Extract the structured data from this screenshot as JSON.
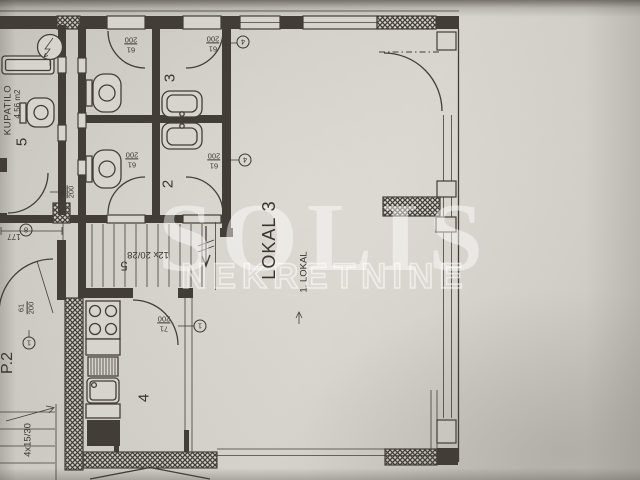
{
  "watermark": {
    "title": "SOLIS",
    "subtitle": "NEKRETNINE"
  },
  "rooms": {
    "kupatilo": {
      "name": "KUPATILO",
      "area": "4.56 m2",
      "number": "5"
    },
    "wc3": {
      "number": "3"
    },
    "wc2": {
      "number": "2"
    },
    "kitchen": {
      "number": "4"
    },
    "lokal": {
      "title": "LOKAL 3",
      "subtitle": "1. LOKAL"
    },
    "p2": {
      "label": "P.2"
    }
  },
  "stairs": {
    "main": {
      "label": "12x 20/28",
      "number": "5"
    },
    "small": {
      "label": "4x15/30"
    }
  },
  "dimensions": {
    "corridor": "177"
  },
  "door_tags": {
    "d61": {
      "w": "61",
      "h": "200"
    },
    "d71": {
      "w": "71",
      "h": "200"
    }
  },
  "markers": {
    "type4": "4",
    "type1": "1",
    "type8": "8"
  },
  "colors": {
    "paper": "#c9c6c0",
    "ink": "#433e37",
    "watermark": "#ffffff"
  }
}
